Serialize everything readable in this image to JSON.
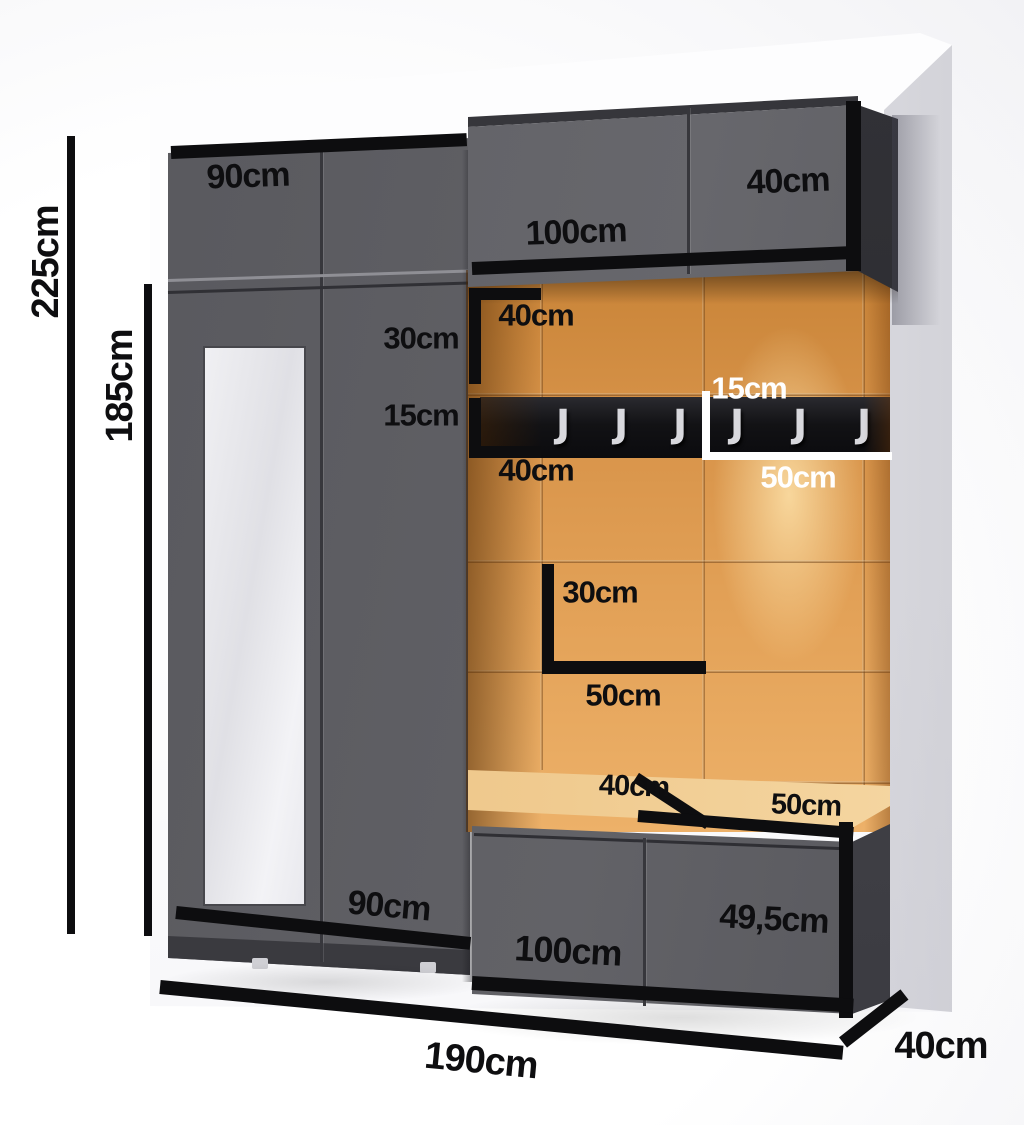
{
  "diagram_type": "furniture-dimension-diagram",
  "subject": "hallway wardrobe set with upholstered panels, coat rail and shoe bench",
  "labels": {
    "total_height": "225cm",
    "open_section_height": "185cm",
    "top_cabinet_width": "90cm",
    "wall_cabinet_width": "100cm",
    "wall_cabinet_height": "40cm",
    "corner_panel_width_top": "40cm",
    "corner_panel_height": "30cm",
    "rail_side_height": "15cm",
    "corner_panel_width_bottom": "40cm",
    "rail_height_white": "15cm",
    "rail_panel_width_white": "50cm",
    "mid_panel_height": "30cm",
    "mid_panel_width": "50cm",
    "seat_left_depth": "40cm",
    "seat_right_width": "50cm",
    "wardrobe_width_bottom": "90cm",
    "bench_cabinet_width": "100cm",
    "bench_cabinet_height": "49,5cm",
    "total_width": "190cm",
    "total_depth": "40cm"
  },
  "rail": {
    "hook_count": 6,
    "hook_glyph": "J"
  },
  "colors": {
    "black": "#0d0d0f",
    "cabinet-gray": "#5c5c61",
    "cabinet-dark": "#36363b",
    "panel-orange": "#d8944a",
    "panel-orange-light": "#f2c27c",
    "cushion-tan": "#eec58a",
    "hook-silver": "#d8d8dd",
    "wall-white": "#fdfdfe",
    "text-white": "#ffffff"
  }
}
